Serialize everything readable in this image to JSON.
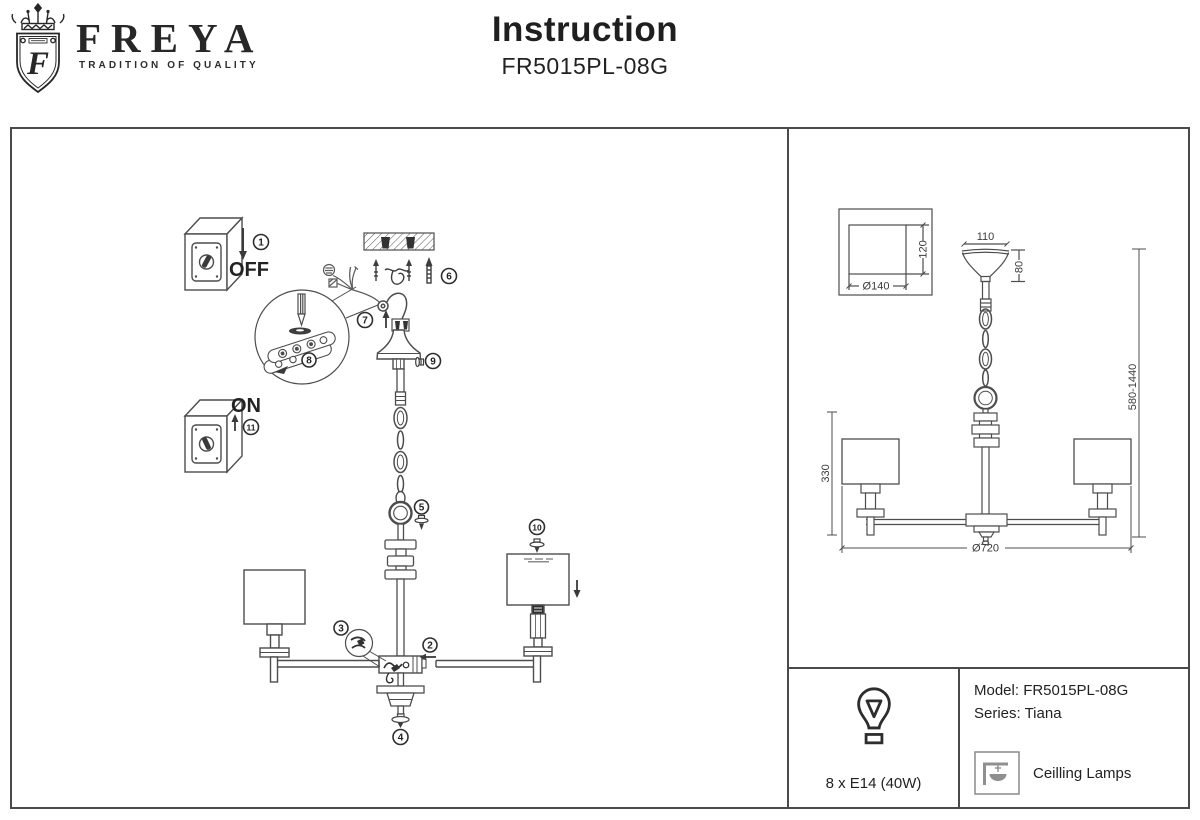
{
  "header": {
    "brand": "FREYA",
    "tagline": "TRADITION OF QUALITY",
    "title": "Instruction",
    "model": "FR5015PL-08G"
  },
  "assembly": {
    "off": "OFF",
    "on": "ON",
    "steps": [
      "1",
      "2",
      "3",
      "4",
      "5",
      "6",
      "7",
      "8",
      "9",
      "10",
      "11"
    ]
  },
  "dims": {
    "plate_w": "Ø140",
    "plate_h": "120",
    "canopy_w": "110",
    "canopy_h": "80",
    "height_range": "580-1440",
    "body_h": "330",
    "diameter": "Ø720"
  },
  "info": {
    "bulb": "8 x E14 (40W)",
    "model": "Model: FR5015PL-08G",
    "series": "Series: Tiana",
    "category": "Ceilling Lamps"
  }
}
